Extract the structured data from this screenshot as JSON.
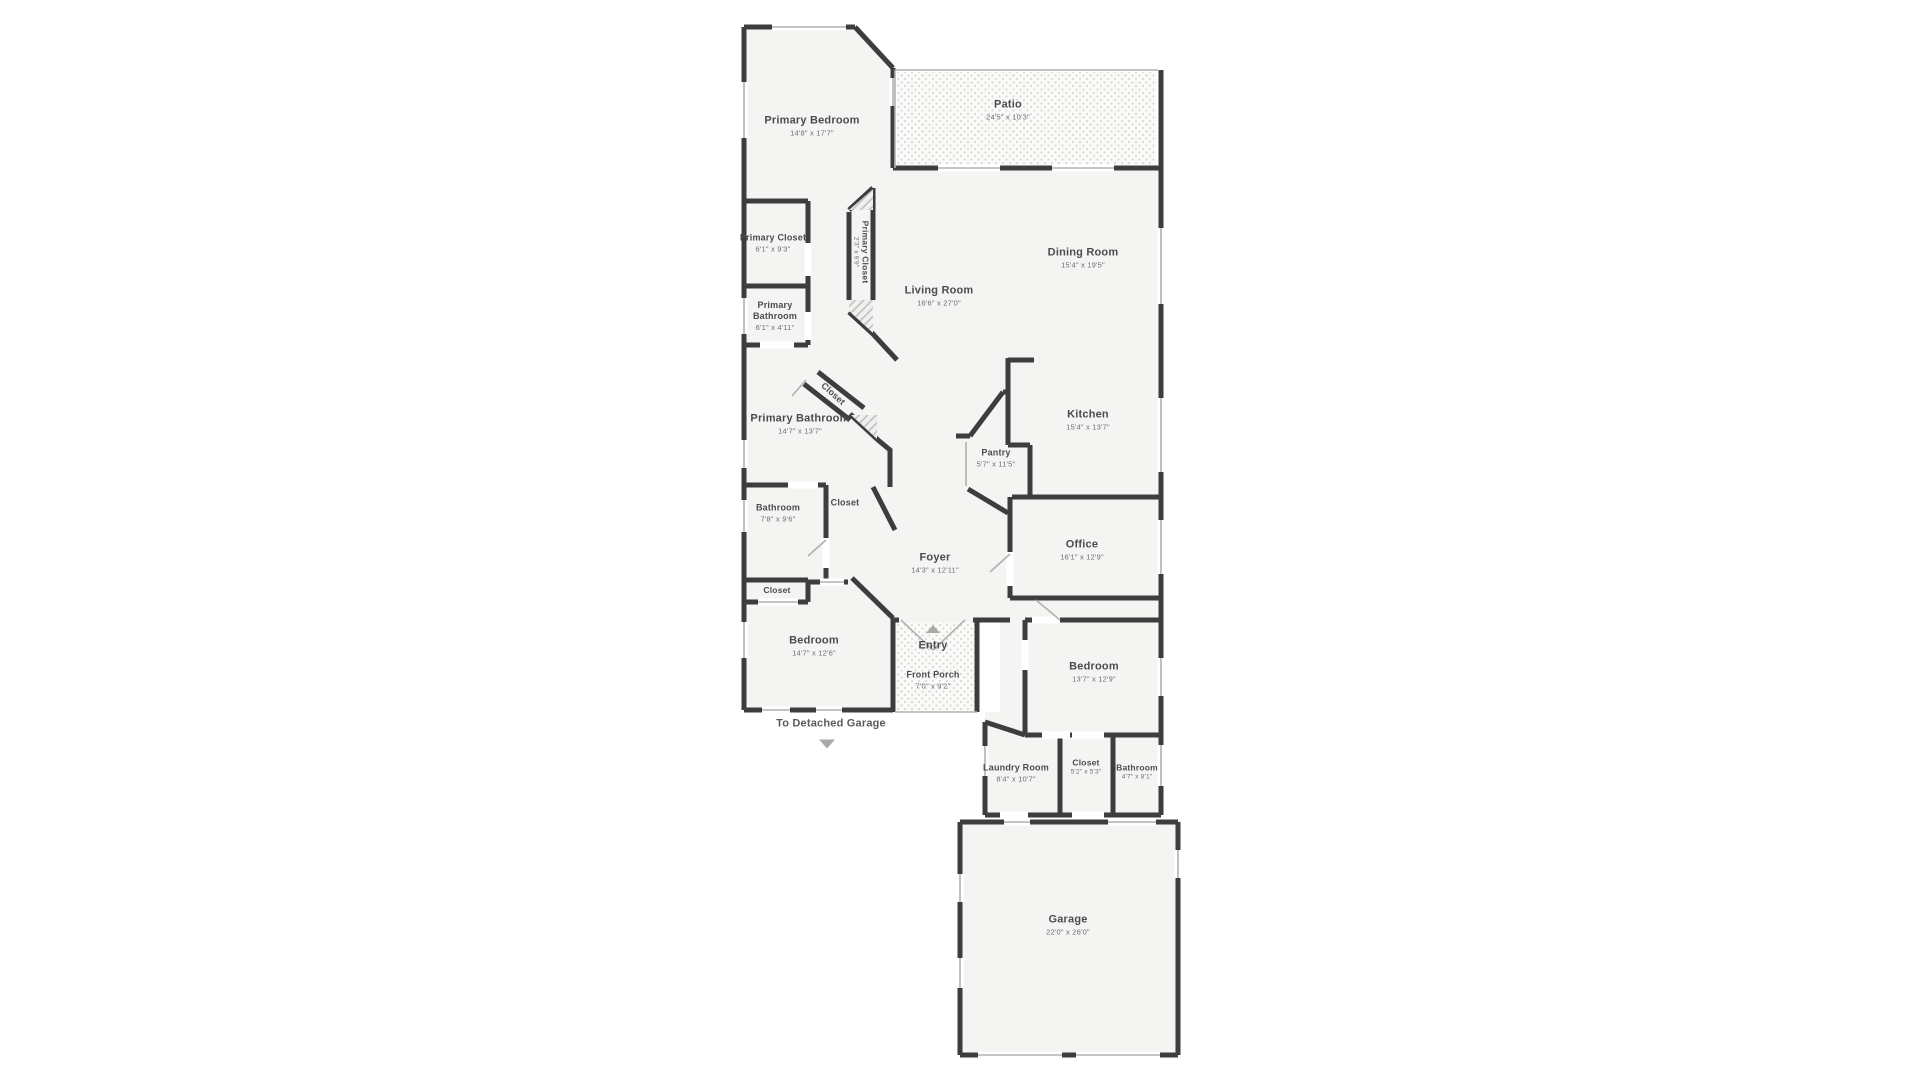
{
  "colors": {
    "wall": "#3d3d3d",
    "room_fill": "#f4f4f3",
    "thin_line": "#b1b1af",
    "dot_fill": "#fafaf9",
    "dot_color": "#d9d9d7",
    "hatch_line": "#c0c0be",
    "text": "#4c4c4c",
    "dim_text": "#6d6d6d",
    "arrow": "#a9a9a7"
  },
  "rooms": {
    "primary_bedroom": {
      "name": "Primary Bedroom",
      "dims": "14'8\" x 17'7\""
    },
    "patio": {
      "name": "Patio",
      "dims": "24'5\" x 10'3\""
    },
    "primary_closet": {
      "name": "Primary Closet",
      "dims": "6'1\" x 9'3\""
    },
    "primary_closet_2": {
      "name": "Primary Closet",
      "dims": "2'3\" x 9'9\""
    },
    "primary_bathroom_small": {
      "name": "Primary Bathroom",
      "dims": "6'1\" x 4'11\""
    },
    "primary_bathroom": {
      "name": "Primary Bathroom",
      "dims": "14'7\" x 13'7\""
    },
    "closet_hall": {
      "name": "Closet"
    },
    "living_room": {
      "name": "Living Room",
      "dims": "16'6\" x 27'0\""
    },
    "dining_room": {
      "name": "Dining Room",
      "dims": "15'4\" x 19'5\""
    },
    "kitchen": {
      "name": "Kitchen",
      "dims": "15'4\" x 13'7\""
    },
    "pantry": {
      "name": "Pantry",
      "dims": "5'7\" x 11'5\""
    },
    "bathroom": {
      "name": "Bathroom",
      "dims": "7'8\" x 9'6\""
    },
    "closet_bath": {
      "name": "Closet"
    },
    "office": {
      "name": "Office",
      "dims": "16'1\" x 12'9\""
    },
    "foyer": {
      "name": "Foyer",
      "dims": "14'3\" x 12'11\""
    },
    "closet_small": {
      "name": "Closet"
    },
    "bedroom_left": {
      "name": "Bedroom",
      "dims": "14'7\" x 12'6\""
    },
    "entry": {
      "name": "Entry"
    },
    "front_porch": {
      "name": "Front Porch",
      "dims": "7'0\" x 9'2\""
    },
    "bedroom_right": {
      "name": "Bedroom",
      "dims": "13'7\" x 12'9\""
    },
    "laundry_room": {
      "name": "Laundry Room",
      "dims": "8'4\" x 10'7\""
    },
    "closet_bedroom": {
      "name": "Closet",
      "dims": "5'2\" x 5'3\""
    },
    "bathroom_2": {
      "name": "Bathroom",
      "dims": "4'7\" x 8'1\""
    },
    "garage": {
      "name": "Garage",
      "dims": "22'0\" x 26'0\""
    }
  },
  "annotations": {
    "to_detached_garage": "To Detached Garage"
  }
}
